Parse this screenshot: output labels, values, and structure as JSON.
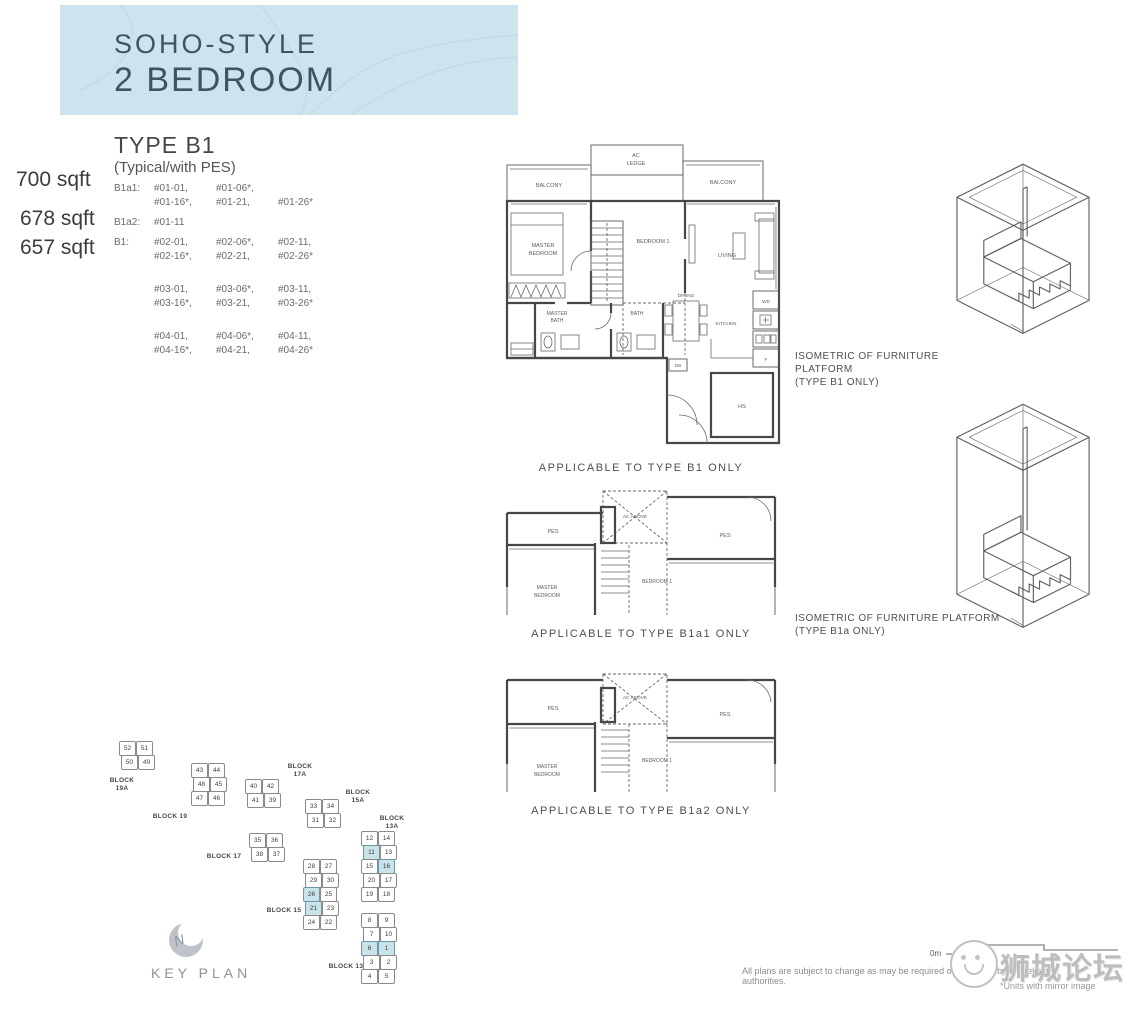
{
  "header": {
    "line1": "SOHO-STYLE",
    "line2": "2 BEDROOM"
  },
  "type_info": {
    "title": "TYPE B1",
    "subtitle": "(Typical/with PES)"
  },
  "areas": [
    "700 sqft",
    "678 sqft",
    "657 sqft"
  ],
  "unit_rows": [
    {
      "label": "B1a1:",
      "groups": [
        {
          "lines": [
            [
              "#01-01,",
              "#01-06*,",
              ""
            ],
            [
              "#01-16*,",
              "#01-21,",
              "#01-26*"
            ]
          ]
        }
      ]
    },
    {
      "label": "B1a2:",
      "groups": [
        {
          "lines": [
            [
              "#01-11",
              "",
              ""
            ]
          ]
        }
      ]
    },
    {
      "label": "B1:",
      "groups": [
        {
          "lines": [
            [
              "#02-01,",
              "#02-06*,",
              "#02-11,"
            ],
            [
              "#02-16*,",
              "#02-21,",
              "#02-26*"
            ]
          ]
        },
        {
          "lines": [
            [
              "#03-01,",
              "#03-06*,",
              "#03-11,"
            ],
            [
              "#03-16*,",
              "#03-21,",
              "#03-26*"
            ]
          ]
        },
        {
          "lines": [
            [
              "#04-01,",
              "#04-06*,",
              "#04-11,"
            ],
            [
              "#04-16*,",
              "#04-21,",
              "#04-26*"
            ]
          ]
        }
      ]
    }
  ],
  "plan_main": {
    "caption": "APPLICABLE TO TYPE B1 ONLY",
    "labels": {
      "balcony_left": "BALCONY",
      "balcony_right": "BALCONY",
      "ac_ledge": [
        "AC",
        "LEDGE"
      ],
      "master_bedroom": [
        "MASTER",
        "BEDROOM"
      ],
      "bedroom1": "BEDROOM 1",
      "living": "LIVING",
      "master_bath": [
        "MASTER",
        "BATH"
      ],
      "bath": "BATH",
      "dining": "DINING",
      "kitchen": "KITCHEN",
      "wd": "WD",
      "f": "F",
      "hs": "HS",
      "db": "DB"
    }
  },
  "plan_b1a1": {
    "caption": "APPLICABLE TO TYPE B1a1 ONLY",
    "labels": {
      "pes": "PES",
      "ac_above": "AC ABOVE",
      "master_bedroom": [
        "MASTER",
        "BEDROOM"
      ],
      "bedroom1": "BEDROOM 1"
    }
  },
  "plan_b1a2": {
    "caption": "APPLICABLE TO TYPE B1a2 ONLY",
    "labels": {
      "pes": "PES",
      "ac_above": "AC ABOVE",
      "master_bedroom": [
        "MASTER",
        "BEDROOM"
      ],
      "bedroom1": "BEDROOM 1"
    }
  },
  "iso1": {
    "line1": "ISOMETRIC OF FURNITURE PLATFORM",
    "line2": "(TYPE B1 ONLY)"
  },
  "iso2": {
    "line1": "ISOMETRIC OF FURNITURE PLATFORM",
    "line2": "(TYPE B1a ONLY)"
  },
  "key_plan": {
    "title": "KEY PLAN",
    "north": "N",
    "highlighted_units": [
      "1",
      "6",
      "11",
      "16",
      "21",
      "26"
    ],
    "clusters": [
      {
        "name": "block-19a",
        "label": "BLOCK 19A",
        "x": 16,
        "y": 6,
        "lx": 0,
        "ly": 42,
        "rows": [
          [
            "52",
            "51"
          ],
          [
            "50",
            "49"
          ]
        ]
      },
      {
        "name": "block-19",
        "label": "BLOCK 19",
        "x": 88,
        "y": 28,
        "lx": 48,
        "ly": 78,
        "rows": [
          [
            "43",
            "44"
          ],
          [
            "48",
            "45"
          ],
          [
            "47",
            "46"
          ]
        ]
      },
      {
        "name": "block-17a",
        "label": "BLOCK 17A",
        "x": 142,
        "y": 44,
        "lx": 178,
        "ly": 28,
        "rows": [
          [
            "40",
            "42"
          ],
          [
            "41",
            "39"
          ]
        ]
      },
      {
        "name": "block-17",
        "label": "BLOCK 17",
        "x": 146,
        "y": 98,
        "lx": 102,
        "ly": 118,
        "rows": [
          [
            "35",
            "36"
          ],
          [
            "38",
            "37"
          ]
        ]
      },
      {
        "name": "block-15a",
        "label": "BLOCK 15A",
        "x": 202,
        "y": 64,
        "lx": 236,
        "ly": 54,
        "rows": [
          [
            "33",
            "34"
          ],
          [
            "31",
            "32"
          ]
        ]
      },
      {
        "name": "block-15",
        "label": "BLOCK 15",
        "x": 200,
        "y": 124,
        "lx": 162,
        "ly": 172,
        "rows": [
          [
            "28",
            "27"
          ],
          [
            "29",
            "30"
          ],
          [
            "26",
            "25"
          ],
          [
            "21",
            "23"
          ],
          [
            "24",
            "22"
          ]
        ]
      },
      {
        "name": "block-13a",
        "label": "BLOCK 13A",
        "x": 258,
        "y": 96,
        "lx": 270,
        "ly": 80,
        "rows": [
          [
            "12",
            "14"
          ],
          [
            "11",
            "13"
          ],
          [
            "15",
            "16"
          ],
          [
            "20",
            "17"
          ],
          [
            "19",
            "18"
          ]
        ]
      },
      {
        "name": "block-13",
        "label": "BLOCK 13",
        "x": 258,
        "y": 178,
        "lx": 224,
        "ly": 228,
        "rows": [
          [
            "8",
            "9"
          ],
          [
            "7",
            "10"
          ],
          [
            "6",
            "1"
          ],
          [
            "3",
            "2"
          ],
          [
            "4",
            "5"
          ]
        ]
      }
    ]
  },
  "footer": {
    "scale_zero": "0m",
    "disclaimer": "All plans are subject to change as may be required or approved by the relevant authorities.",
    "mirror_note": "*Units with mirror image",
    "watermark": "狮城论坛"
  },
  "colors": {
    "header_bg": "#cfe3ef",
    "header_text": "#3e5465",
    "highlight": "#c8e3e9"
  }
}
